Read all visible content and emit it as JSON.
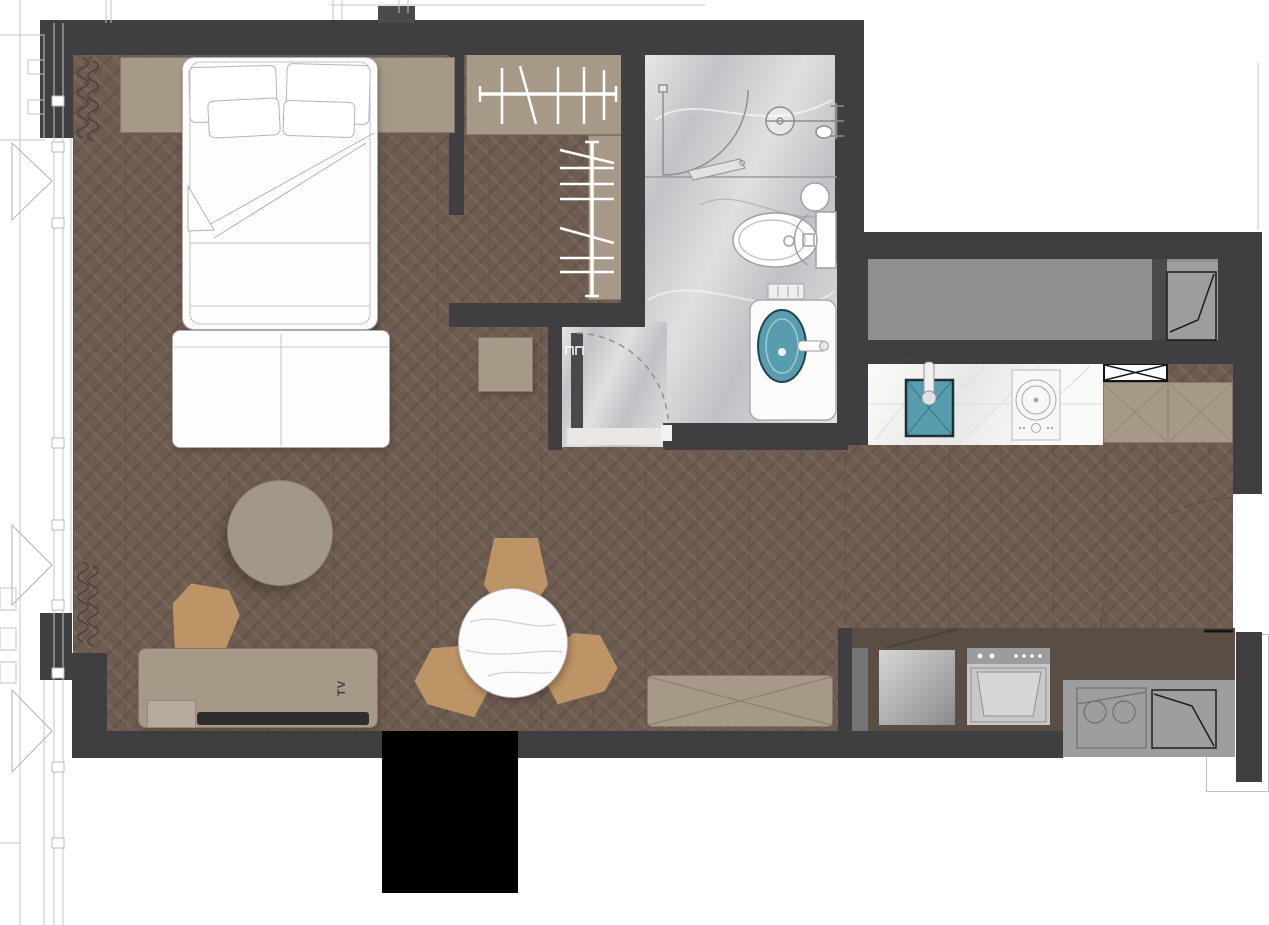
{
  "meta": {
    "type": "studio-apartment-floor-plan",
    "width": 1269,
    "height": 925
  },
  "labels": {
    "tv": "TV",
    "sink": "KB"
  },
  "palette": {
    "wall": "#3f3f41",
    "wood_floor": "#6e5c50",
    "marble_floor": "#cbcbce",
    "kitchen_counter": "#f3f2f0",
    "corridor_gray": "#8f8f91",
    "furniture_taupe": "#a79988",
    "chair_tan": "#bd9466",
    "sink_teal": "#579dae",
    "shaft_black": "#000000",
    "exterior_line": "#c2c2c4"
  },
  "rooms": [
    {
      "name": "sleeping-area"
    },
    {
      "name": "walk-in-wardrobe"
    },
    {
      "name": "bathroom"
    },
    {
      "name": "shower-zone"
    },
    {
      "name": "living-dining-area"
    },
    {
      "name": "kitchen"
    },
    {
      "name": "entry"
    },
    {
      "name": "corridor"
    },
    {
      "name": "utility-platform"
    }
  ],
  "furniture": [
    "double-bed",
    "pillows",
    "bed-bench",
    "headboard-panel",
    "wardrobe-rods",
    "round-rug",
    "armchair",
    "side-table",
    "dining-table",
    "dining-chairs",
    "tv-console",
    "tv",
    "storage-bench",
    "toilet",
    "vanity-with-sink",
    "stool",
    "shower-set",
    "kitchen-sink",
    "cooktop",
    "range-hood-cabinet",
    "tall-cabinets",
    "washing-machine",
    "dryer",
    "ac-outdoor-unit",
    "entry-door",
    "bathroom-door",
    "shower-door",
    "corridor-door",
    "curtains",
    "window-wall",
    "shaft"
  ]
}
